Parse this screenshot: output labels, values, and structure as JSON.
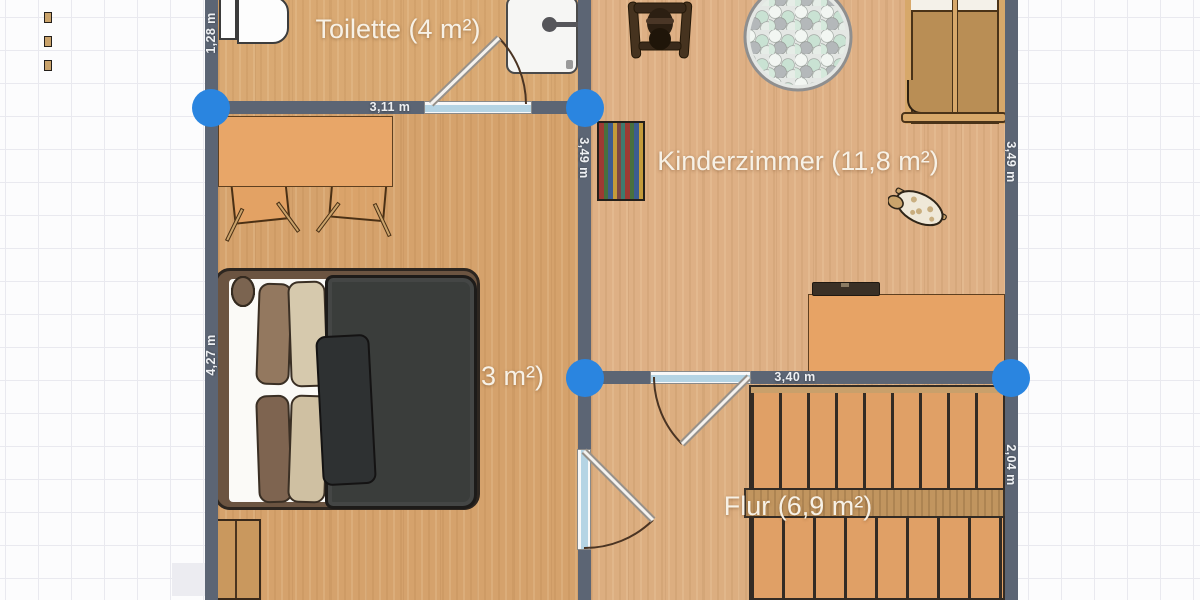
{
  "plan": {
    "rooms": [
      {
        "name": "toilette",
        "label": "Toilette (4 m²)"
      },
      {
        "name": "kinderzimmer",
        "label": "Kinderzimmer (11,8 m²)"
      },
      {
        "name": "schlafzimmer",
        "label": "3 m²)"
      },
      {
        "name": "flur",
        "label": "Flur (6,9 m²)"
      }
    ],
    "dimensions": {
      "toilette_left_wall": "1,28 m",
      "toilette_bottom_wall": "3,11 m",
      "kinderzimmer_left_wall": "3,49 m",
      "kinderzimmer_right_wall": "3,49 m",
      "schlafzimmer_left_wall": "4,27 m",
      "flur_top_wall": "3,40 m",
      "flur_right_wall": "2,04 m",
      "door_width": "0,90 m"
    },
    "colors": {
      "wall": "#5c6574",
      "junction_point": "#2a85e0",
      "floor_wood": "#d8a872",
      "furniture_accent": "#e8a668",
      "door_frame": "#b5d4e4",
      "label_text": "#f7f1e6"
    },
    "furniture": [
      "toilet",
      "shower",
      "dining-table",
      "chair",
      "double-bed",
      "wardrobe",
      "rocking-horse",
      "ball-pit",
      "crib",
      "bookshelf",
      "toy-sheep",
      "desk",
      "laptop",
      "staircase"
    ]
  }
}
